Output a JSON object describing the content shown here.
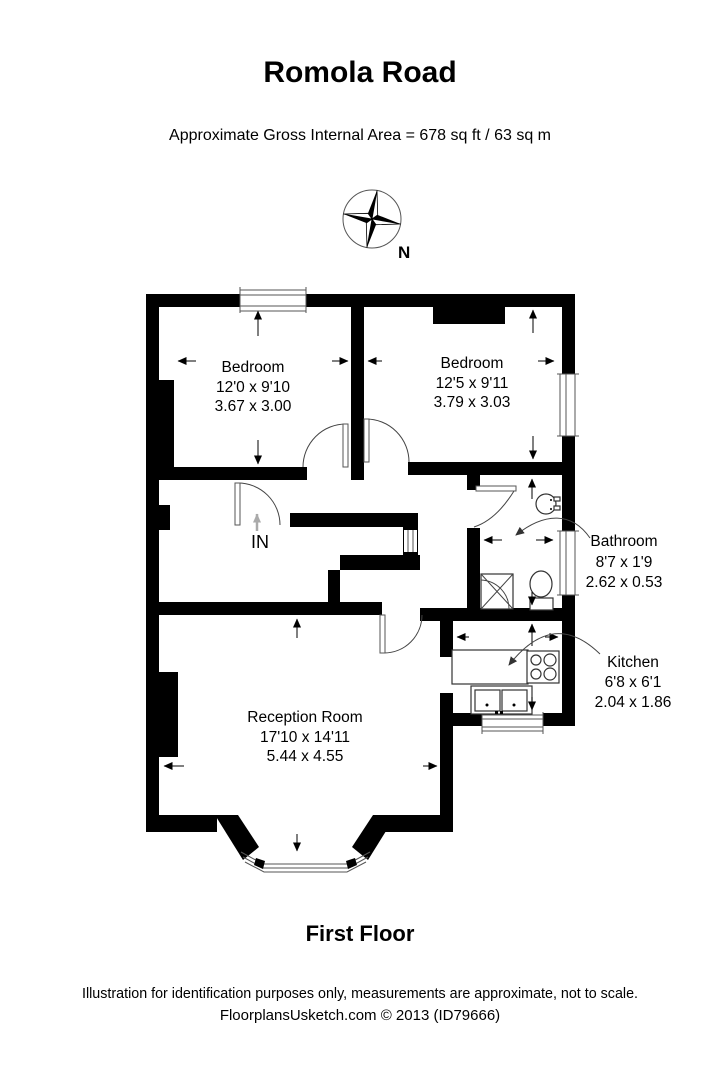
{
  "title": "Romola Road",
  "subtitle": "Approximate Gross Internal Area = 678 sq ft / 63 sq m",
  "floor_label": "First Floor",
  "footer": {
    "line1": "Illustration for identification purposes only, measurements are approximate, not to scale.",
    "line2": "FloorplansUsketch.com © 2013 (ID79666)"
  },
  "compass": {
    "icon": "compass-rose",
    "north_label": "N"
  },
  "entrance": {
    "label": "IN",
    "icon": "up-arrow"
  },
  "rooms": [
    {
      "id": "bedroom-left",
      "name": "Bedroom",
      "imperial": "12'0 x 9'10",
      "metric": "3.67 x 3.00"
    },
    {
      "id": "bedroom-right",
      "name": "Bedroom",
      "imperial": "12'5 x 9'11",
      "metric": "3.79 x 3.03"
    },
    {
      "id": "bathroom",
      "name": "Bathroom",
      "imperial": "8'7 x 1'9",
      "metric": "2.62 x 0.53"
    },
    {
      "id": "kitchen",
      "name": "Kitchen",
      "imperial": "6'8 x 6'1",
      "metric": "2.04 x 1.86"
    },
    {
      "id": "reception",
      "name": "Reception Room",
      "imperial": "17'10 x 14'11",
      "metric": "5.44 x 4.55"
    }
  ],
  "fixtures": [
    "shower",
    "toilet",
    "basin",
    "hob",
    "double-sink",
    "counter"
  ],
  "colors": {
    "wall": "#000000",
    "background": "#ffffff",
    "door_arc": "#555555",
    "entrance_arrow": "#aaaaaa"
  }
}
